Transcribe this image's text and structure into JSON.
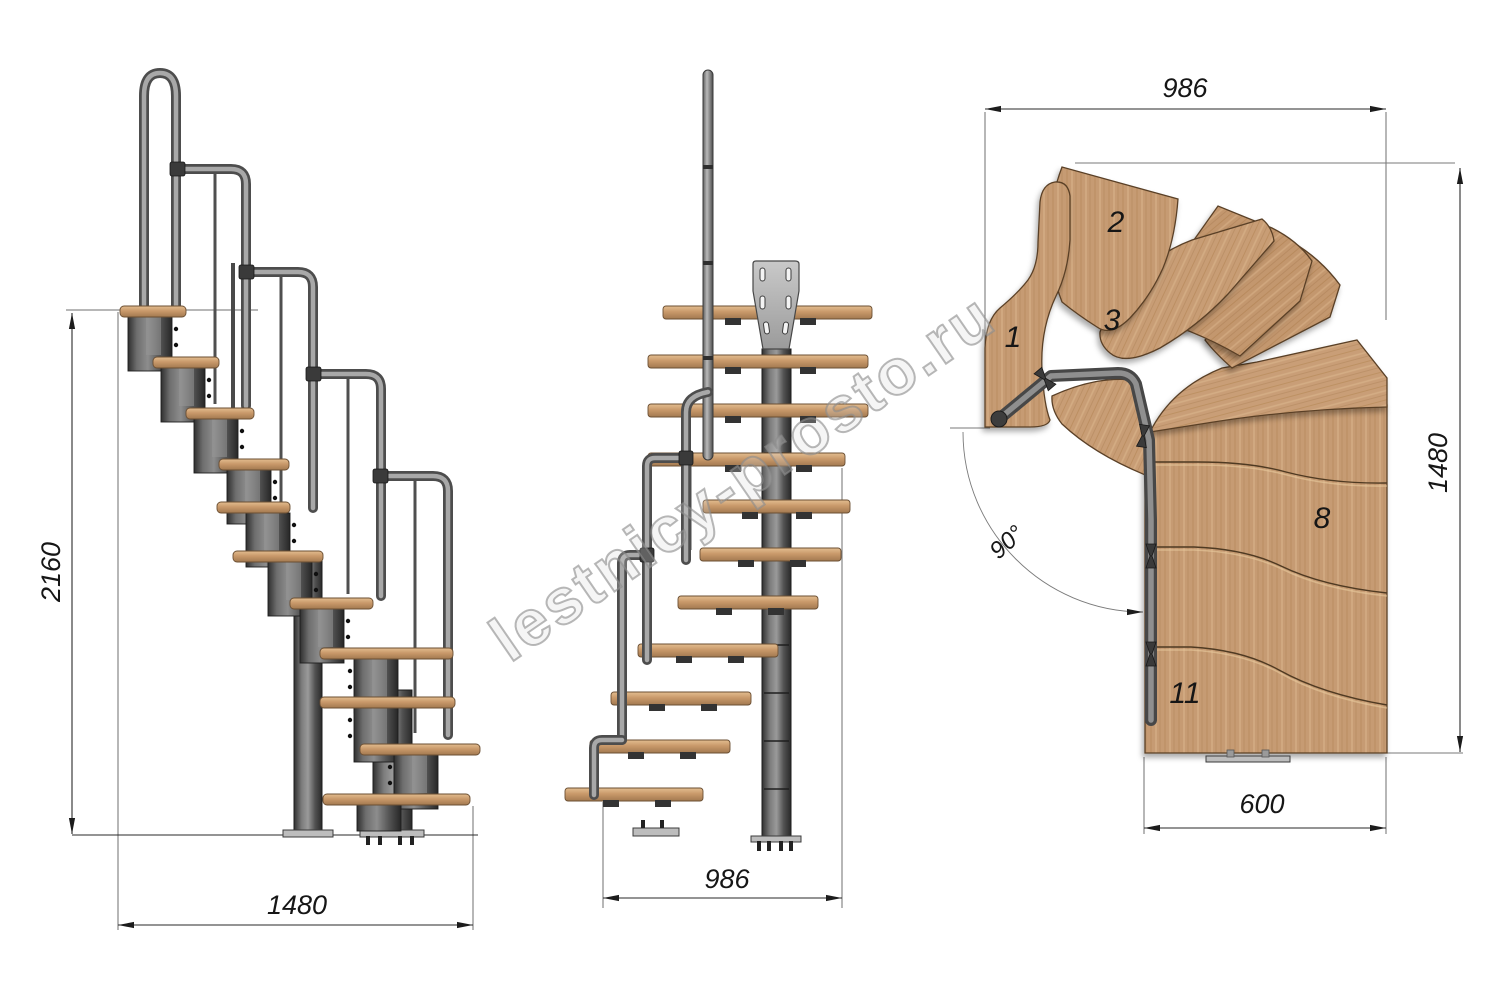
{
  "watermark": {
    "text": "lestnicy-prosto.ru"
  },
  "views": {
    "side": {
      "height_dim": "2160",
      "run_dim": "1480"
    },
    "front": {
      "width_dim": "986"
    },
    "plan": {
      "width_dim": "986",
      "depth_dim": "1480",
      "flight_width_dim": "600",
      "angle": "90°",
      "treads": {
        "n1": "1",
        "n2": "2",
        "n3": "3",
        "n8": "8",
        "n11": "11"
      }
    }
  },
  "colors": {
    "wood": "#c69b73",
    "wood_dark": "#a87a4e",
    "metal_dark": "#4a4a4a",
    "metal_light": "#a8a8a8",
    "dimension": "#161616",
    "watermark_gray": "#8c8c8c"
  }
}
